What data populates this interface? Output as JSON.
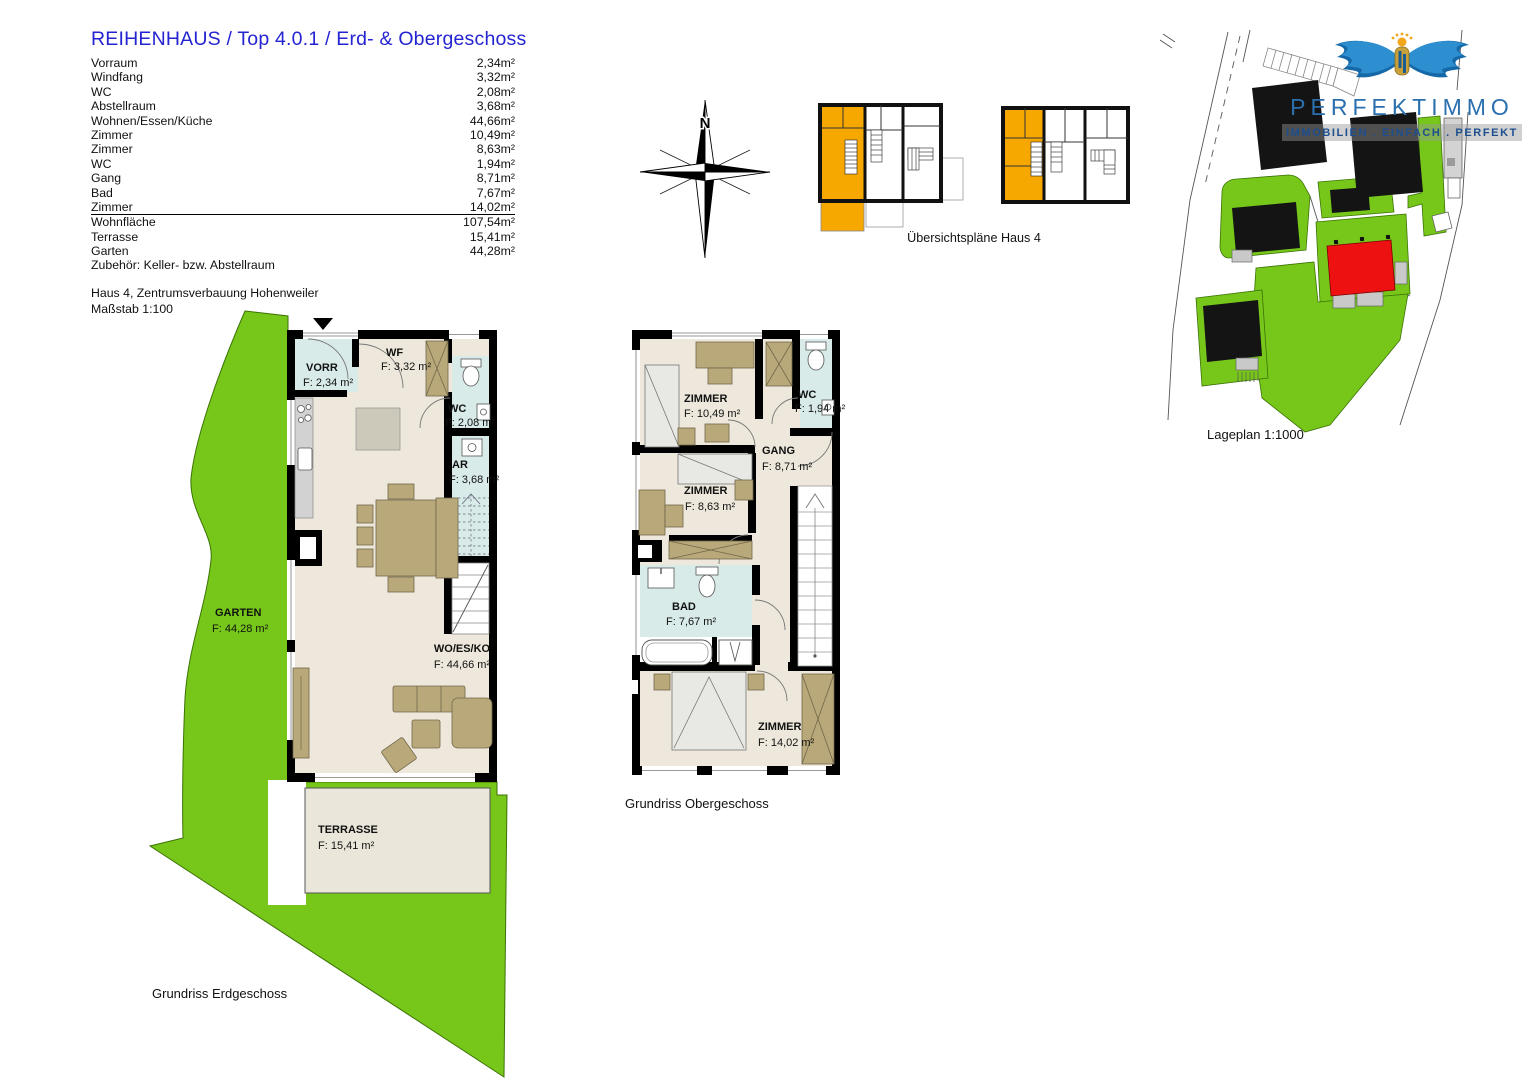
{
  "header": {
    "title": "REIHENHAUS / Top 4.0.1 / Erd- & Obergeschoss",
    "rooms": [
      {
        "label": "Vorraum",
        "value": "2,34m²"
      },
      {
        "label": "Windfang",
        "value": "3,32m²"
      },
      {
        "label": "WC",
        "value": "2,08m²"
      },
      {
        "label": "Abstellraum",
        "value": "3,68m²"
      },
      {
        "label": "Wohnen/Essen/Küche",
        "value": "44,66m²"
      },
      {
        "label": "Zimmer",
        "value": "10,49m²"
      },
      {
        "label": "Zimmer",
        "value": "8,63m²"
      },
      {
        "label": "WC",
        "value": "1,94m²"
      },
      {
        "label": "Gang",
        "value": "8,71m²"
      },
      {
        "label": "Bad",
        "value": "7,67m²"
      },
      {
        "label": "Zimmer",
        "value": "14,02m²"
      }
    ],
    "totals": [
      {
        "label": "Wohnfläche",
        "value": "107,54m²"
      },
      {
        "label": "Terrasse",
        "value": "15,41m²"
      },
      {
        "label": "Garten",
        "value": "44,28m²"
      }
    ],
    "note": "Zubehör: Keller- bzw. Abstellraum",
    "project": "Haus 4, Zentrumsverbauung Hohenweiler",
    "scale": "Maßstab 1:100"
  },
  "compass": {
    "north_label": "N"
  },
  "overview": {
    "caption": "Übersichtspläne Haus 4",
    "highlight_color": "#F6A800"
  },
  "logo": {
    "name": "PERFEKTIMMO",
    "tagline": "IMMOBILIEN . EINFACH . PERFEKT"
  },
  "siteplan": {
    "caption": "Lageplan 1:1000",
    "highlight_color": "#EE1111",
    "green_color": "#76C71A"
  },
  "ground_floor": {
    "caption": "Grundriss Erdgeschoss",
    "rooms": {
      "vorr": {
        "name": "VORR",
        "area": "F: 2,34 m²"
      },
      "wf": {
        "name": "WF",
        "area": "F: 3,32 m²"
      },
      "wc": {
        "name": "WC",
        "area": "F: 2,08 m²"
      },
      "ar": {
        "name": "AR",
        "area": "F: 3,68 m²"
      },
      "wo": {
        "name": "WO/ES/KO",
        "area": "F: 44,66 m²"
      },
      "garten": {
        "name": "GARTEN",
        "area": "F:  44,28 m²"
      },
      "terrasse": {
        "name": "TERRASSE",
        "area": "F:  15,41 m²"
      }
    }
  },
  "upper_floor": {
    "caption": "Grundriss Obergeschoss",
    "rooms": {
      "z1": {
        "name": "ZIMMER",
        "area": "F: 10,49 m²"
      },
      "wc": {
        "name": "WC",
        "area": "F: 1,94 m²"
      },
      "gang": {
        "name": "GANG",
        "area": "F: 8,71 m²"
      },
      "z2": {
        "name": "ZIMMER",
        "area": "F: 8,63 m²"
      },
      "bad": {
        "name": "BAD",
        "area": "F: 7,67 m²"
      },
      "z3": {
        "name": "ZIMMER",
        "area": "F: 14,02 m²"
      }
    }
  }
}
